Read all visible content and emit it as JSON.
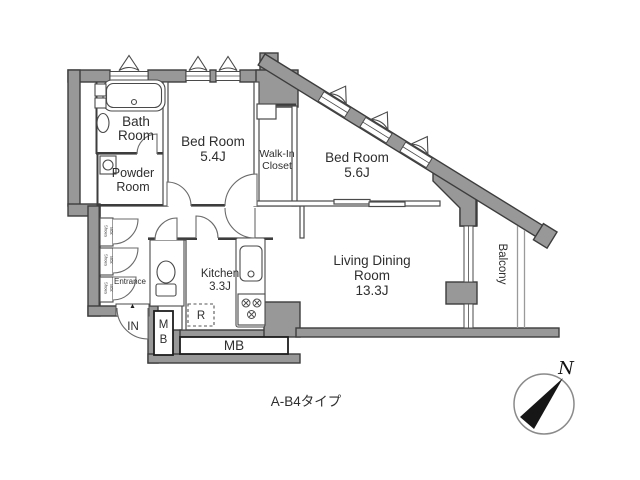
{
  "floorplan": {
    "title": "A-B4タイプ",
    "compass": {
      "north": "N"
    },
    "rooms": {
      "bath": {
        "name_line1": "Bath",
        "name_line2": "Room"
      },
      "powder": {
        "name_line1": "Powder",
        "name_line2": "Room"
      },
      "bedroom_a": {
        "name": "Bed Room",
        "size": "5.4J"
      },
      "bedroom_b": {
        "name": "Bed Room",
        "size": "5.6J"
      },
      "walk_in_closet": {
        "name_line1": "Walk-In",
        "name_line2": "Closet"
      },
      "living_dining": {
        "name_line1": "Living Dining",
        "name_line2": "Room",
        "size": "13.3J"
      },
      "kitchen": {
        "name": "Kitchen",
        "size": "3.3J"
      },
      "entrance": {
        "name": "Entrance"
      },
      "balcony": {
        "name": "Balcony"
      }
    },
    "labels": {
      "in": "IN",
      "mb_m": "M",
      "mb_b": "B",
      "mb": "MB",
      "refrigerator": "R",
      "shoes": "Shoes",
      "box": "Box"
    },
    "colors": {
      "wall_fill": "#989898",
      "wall_outline": "#3d3d3d",
      "text": "#2e2e2e"
    }
  }
}
